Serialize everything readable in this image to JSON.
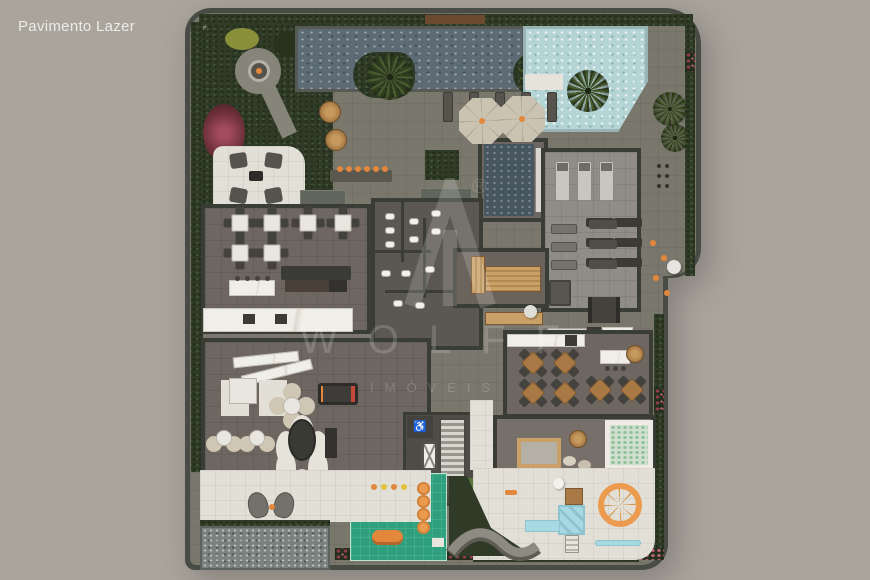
{
  "page": {
    "title": "Pavimento Lazer"
  },
  "watermark": {
    "brand": "WOLFF",
    "subtitle": "IMÓVEIS",
    "registered": "®"
  },
  "palette": {
    "bg": "#a9a49c",
    "title": "#edebe6",
    "wall": "#484c44",
    "wallDark": "#3a3d36",
    "deck": "#7a776c",
    "floor": "#6e6761",
    "floorDark": "#5b5751",
    "gymFloor": "#908d86",
    "pave": "#e2dfd6",
    "poolDark": "#5d6c74",
    "poolLight": "#b5d4d6",
    "spa": "#475660",
    "water": "#7a827f",
    "hedge": "#2f3b26",
    "hedgeDark": "#222d1a",
    "leaf": "#44563a",
    "mat": "#2fa07d",
    "marble": "#f0eee8",
    "tableWhite": "#e9e6df",
    "chair": "#44423c",
    "wood": "#a87944",
    "woodLight": "#c9a068",
    "orange": "#e2873c",
    "playBlue": "#a8d8e2",
    "playOrange": "#ec9b4e",
    "umbrella": "#cbc3b2",
    "flowerRed": "#8e3c4c",
    "flowerPink": "#b06071",
    "treadmill": "#c8c6c0",
    "watermark": "rgba(255,255,255,0.17)"
  }
}
